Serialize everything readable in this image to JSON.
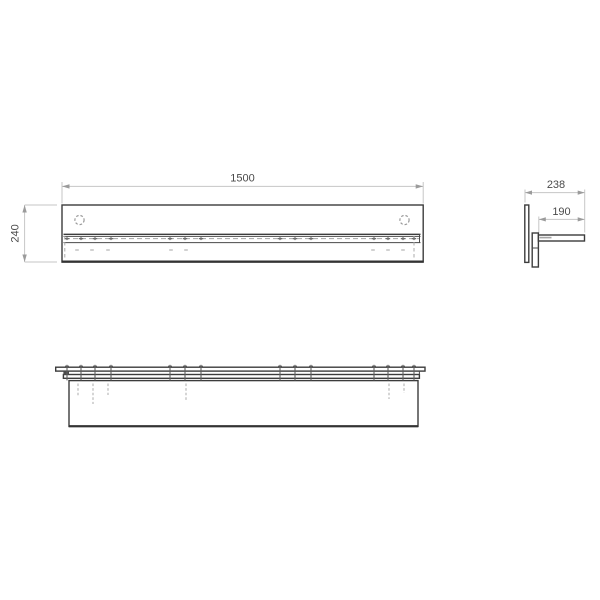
{
  "drawing": {
    "title": "shelf-technical-drawing",
    "colors": {
      "background": "#ffffff",
      "edge": "#3c3c3c",
      "hidden": "#a4a4a4",
      "dim_line": "#c6c6c6",
      "dim_text": "#4a4a4a"
    },
    "views": {
      "front": {
        "name": "front-elevation",
        "dimensions": [
          {
            "id": "width",
            "label": "1500"
          },
          {
            "id": "height",
            "label": "240"
          }
        ],
        "holes": 2
      },
      "side": {
        "name": "side-section",
        "dimensions": [
          {
            "id": "depth_total",
            "label": "238"
          },
          {
            "id": "depth_shelf",
            "label": "190"
          }
        ]
      },
      "plan": {
        "name": "plan-underside",
        "dimensions": []
      }
    },
    "screws": {
      "front_top_x": [
        67,
        81,
        95,
        111,
        170,
        185,
        201,
        280,
        295,
        311,
        374,
        388,
        403,
        414
      ],
      "front_lower_x": [
        77,
        92,
        108,
        171,
        186,
        373,
        388,
        403
      ],
      "plan_tick_x": [
        67,
        81,
        95,
        111,
        170,
        185,
        201,
        280,
        295,
        311,
        374,
        388,
        403,
        414
      ],
      "plan_tails": [
        {
          "x": 78,
          "y2": 397
        },
        {
          "x": 93,
          "y2": 404
        },
        {
          "x": 108,
          "y2": 395
        },
        {
          "x": 186,
          "y2": 401
        },
        {
          "x": 389,
          "y2": 399
        },
        {
          "x": 404,
          "y2": 393
        }
      ]
    }
  }
}
